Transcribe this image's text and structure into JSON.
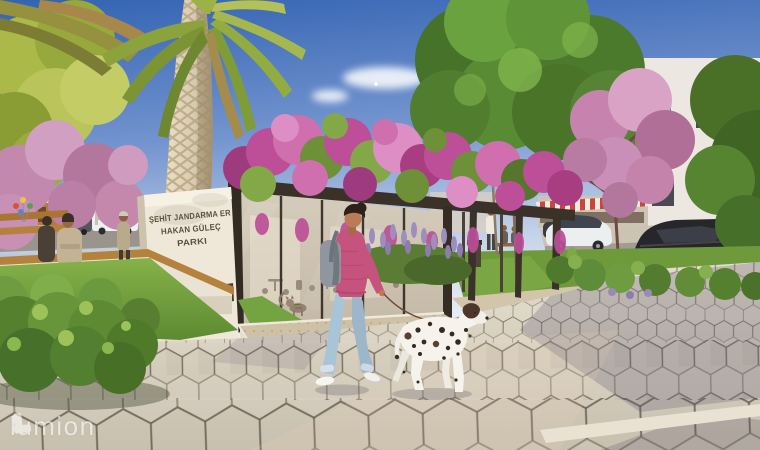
{
  "sign": {
    "line1": "ŞEHİT JANDARMA ER",
    "line2": "HAKAN GÜLEÇ",
    "line3": "PARKI",
    "band": "AN BELEDİYESİ"
  },
  "watermark": {
    "text": "lumion"
  },
  "icons": {
    "watermark_logo": "lumion-logo"
  },
  "colors": {
    "sky_top": "#3363b2",
    "sky_horizon": "#e8edf4",
    "blossom_pink": "#c98fb8",
    "bougainvillea_flower": "#bc4f97",
    "foliage_green": "#5d8a33",
    "grass_green": "#74a342",
    "lavender_purple": "#9a8ab8",
    "paver_light": "#ded6c5",
    "pavement_shadow": "#8c84a0",
    "pavilion_frame": "#3a3128",
    "glass_tint": "#d0c4b1",
    "sign_panel": "#efe8d9",
    "sign_band": "#4a4136",
    "sign_text": "#57503f",
    "sweater_pink": "#c5537d",
    "jeans_blue": "#a9c3d7",
    "dog_white": "#f6f3ec",
    "dog_spot": "#332a24",
    "palm_trunk": "#d8ccb0",
    "watermark_white": "#ffffff"
  }
}
